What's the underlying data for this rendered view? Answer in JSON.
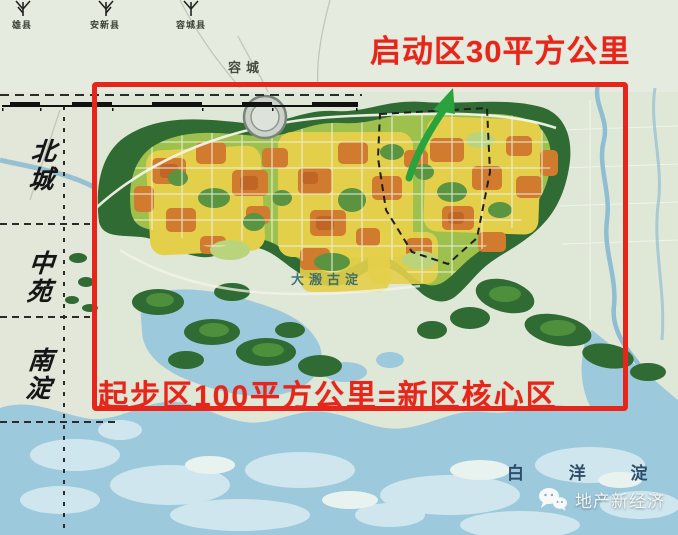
{
  "annotations": {
    "startup_label": "启动区30平方公里",
    "core_label": "起步区100平方公里=新区核心区"
  },
  "legend": {
    "county_labels": [
      "雄县",
      "安新县",
      "容城县"
    ]
  },
  "map_labels": {
    "regions": [
      "北城",
      "中苑",
      "南淀"
    ],
    "town": "容城",
    "lake": "白 洋 淀",
    "ancient_lake": "大溵古淀"
  },
  "watermark": {
    "text": "地产新经济",
    "icon": "wechat-icon"
  },
  "colors": {
    "annotation_red": "#e7261b",
    "arrow_green": "#2aa33c",
    "water_blue": "#9dc9dd",
    "forest_green": "#2f6b33",
    "urban_yellow": "#e4cf4a",
    "urban_orange": "#d07b2e"
  }
}
